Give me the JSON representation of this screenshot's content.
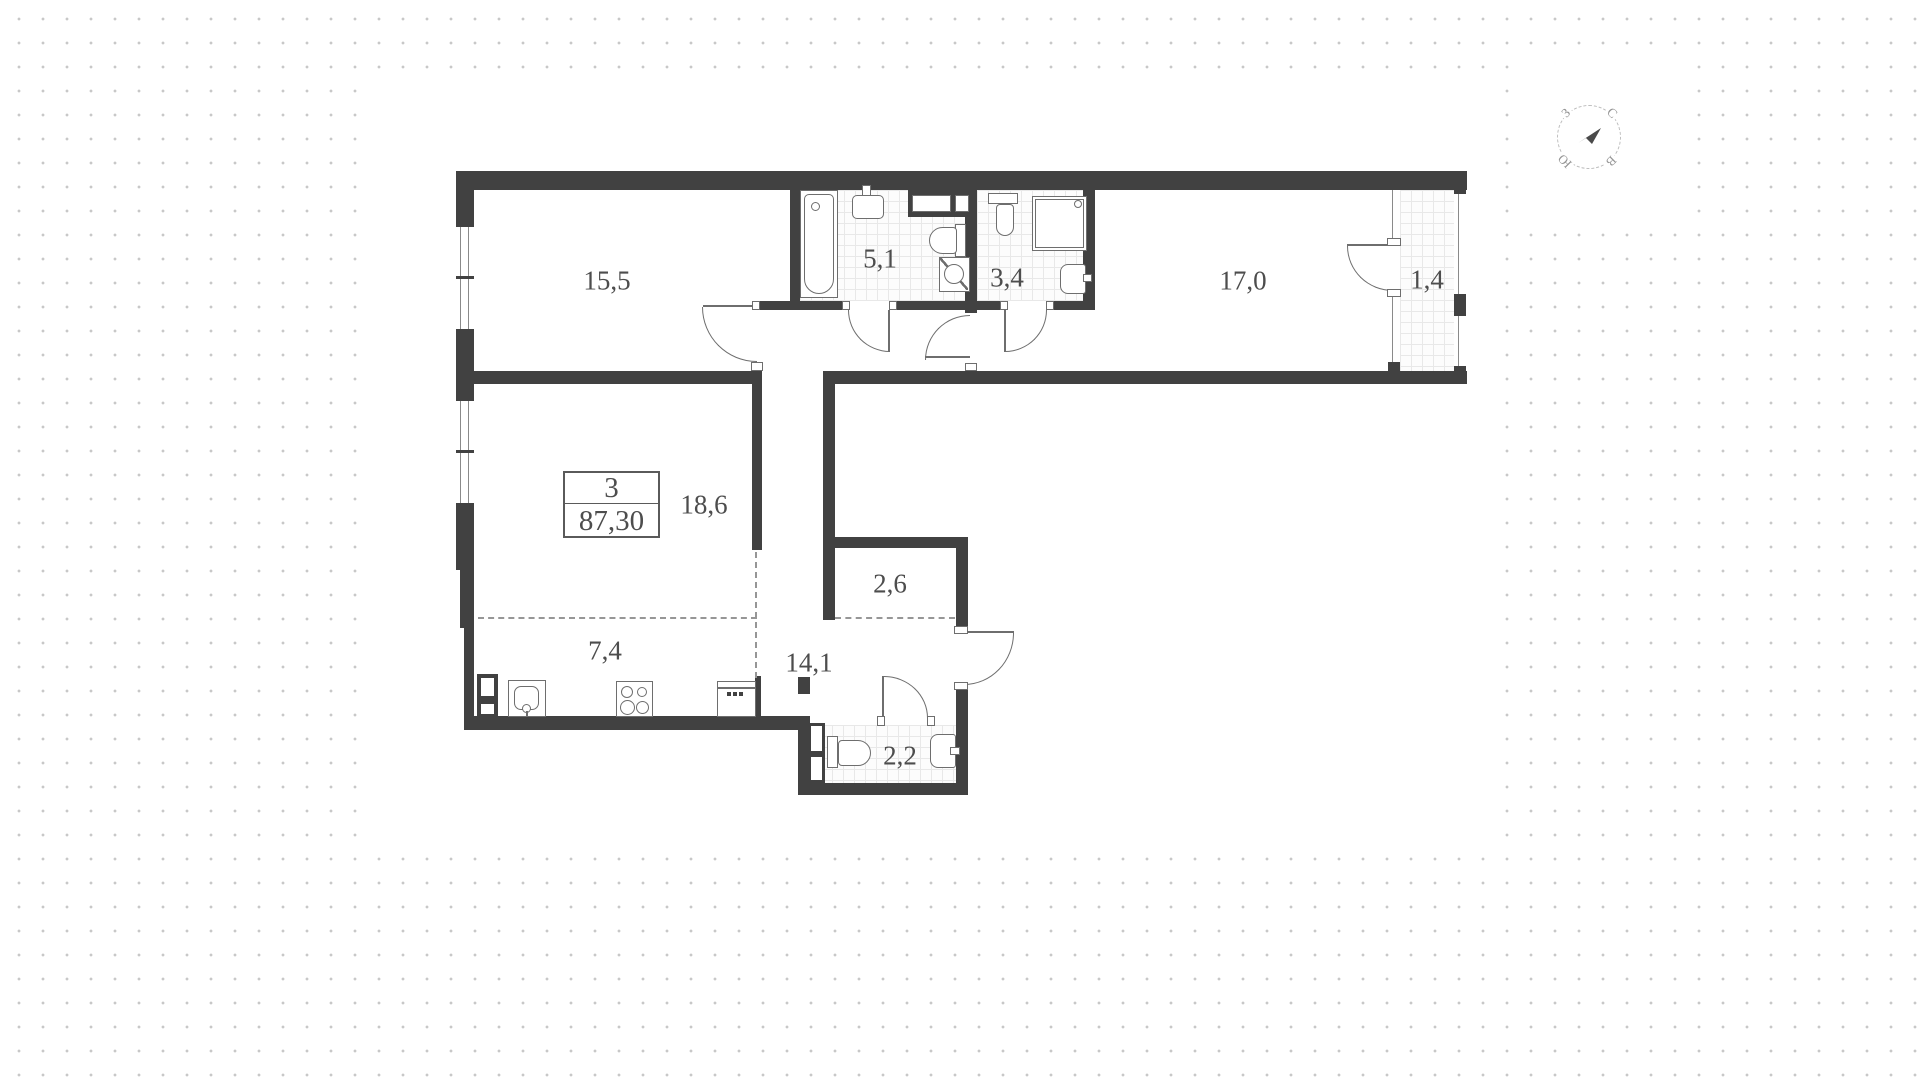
{
  "apartment": {
    "number": "3",
    "total_area": "87,30"
  },
  "rooms": {
    "r15_5": {
      "area": "15,5"
    },
    "r5_1": {
      "area": "5,1"
    },
    "r3_4": {
      "area": "3,4"
    },
    "r17_0": {
      "area": "17,0"
    },
    "r1_4": {
      "area": "1,4"
    },
    "r18_6": {
      "area": "18,6"
    },
    "r2_6": {
      "area": "2,6"
    },
    "r7_4": {
      "area": "7,4"
    },
    "r14_1": {
      "area": "14,1"
    },
    "r2_2": {
      "area": "2,2"
    }
  },
  "compass": {
    "north": "С",
    "east": "В",
    "south": "Ю",
    "west": "З"
  },
  "colors": {
    "wall": "#414141",
    "fixture_line": "#6e6e6e",
    "label_text": "#4d4d4d",
    "background_dots": "#c8c8c8",
    "tile_line": "#e8e8e8"
  }
}
